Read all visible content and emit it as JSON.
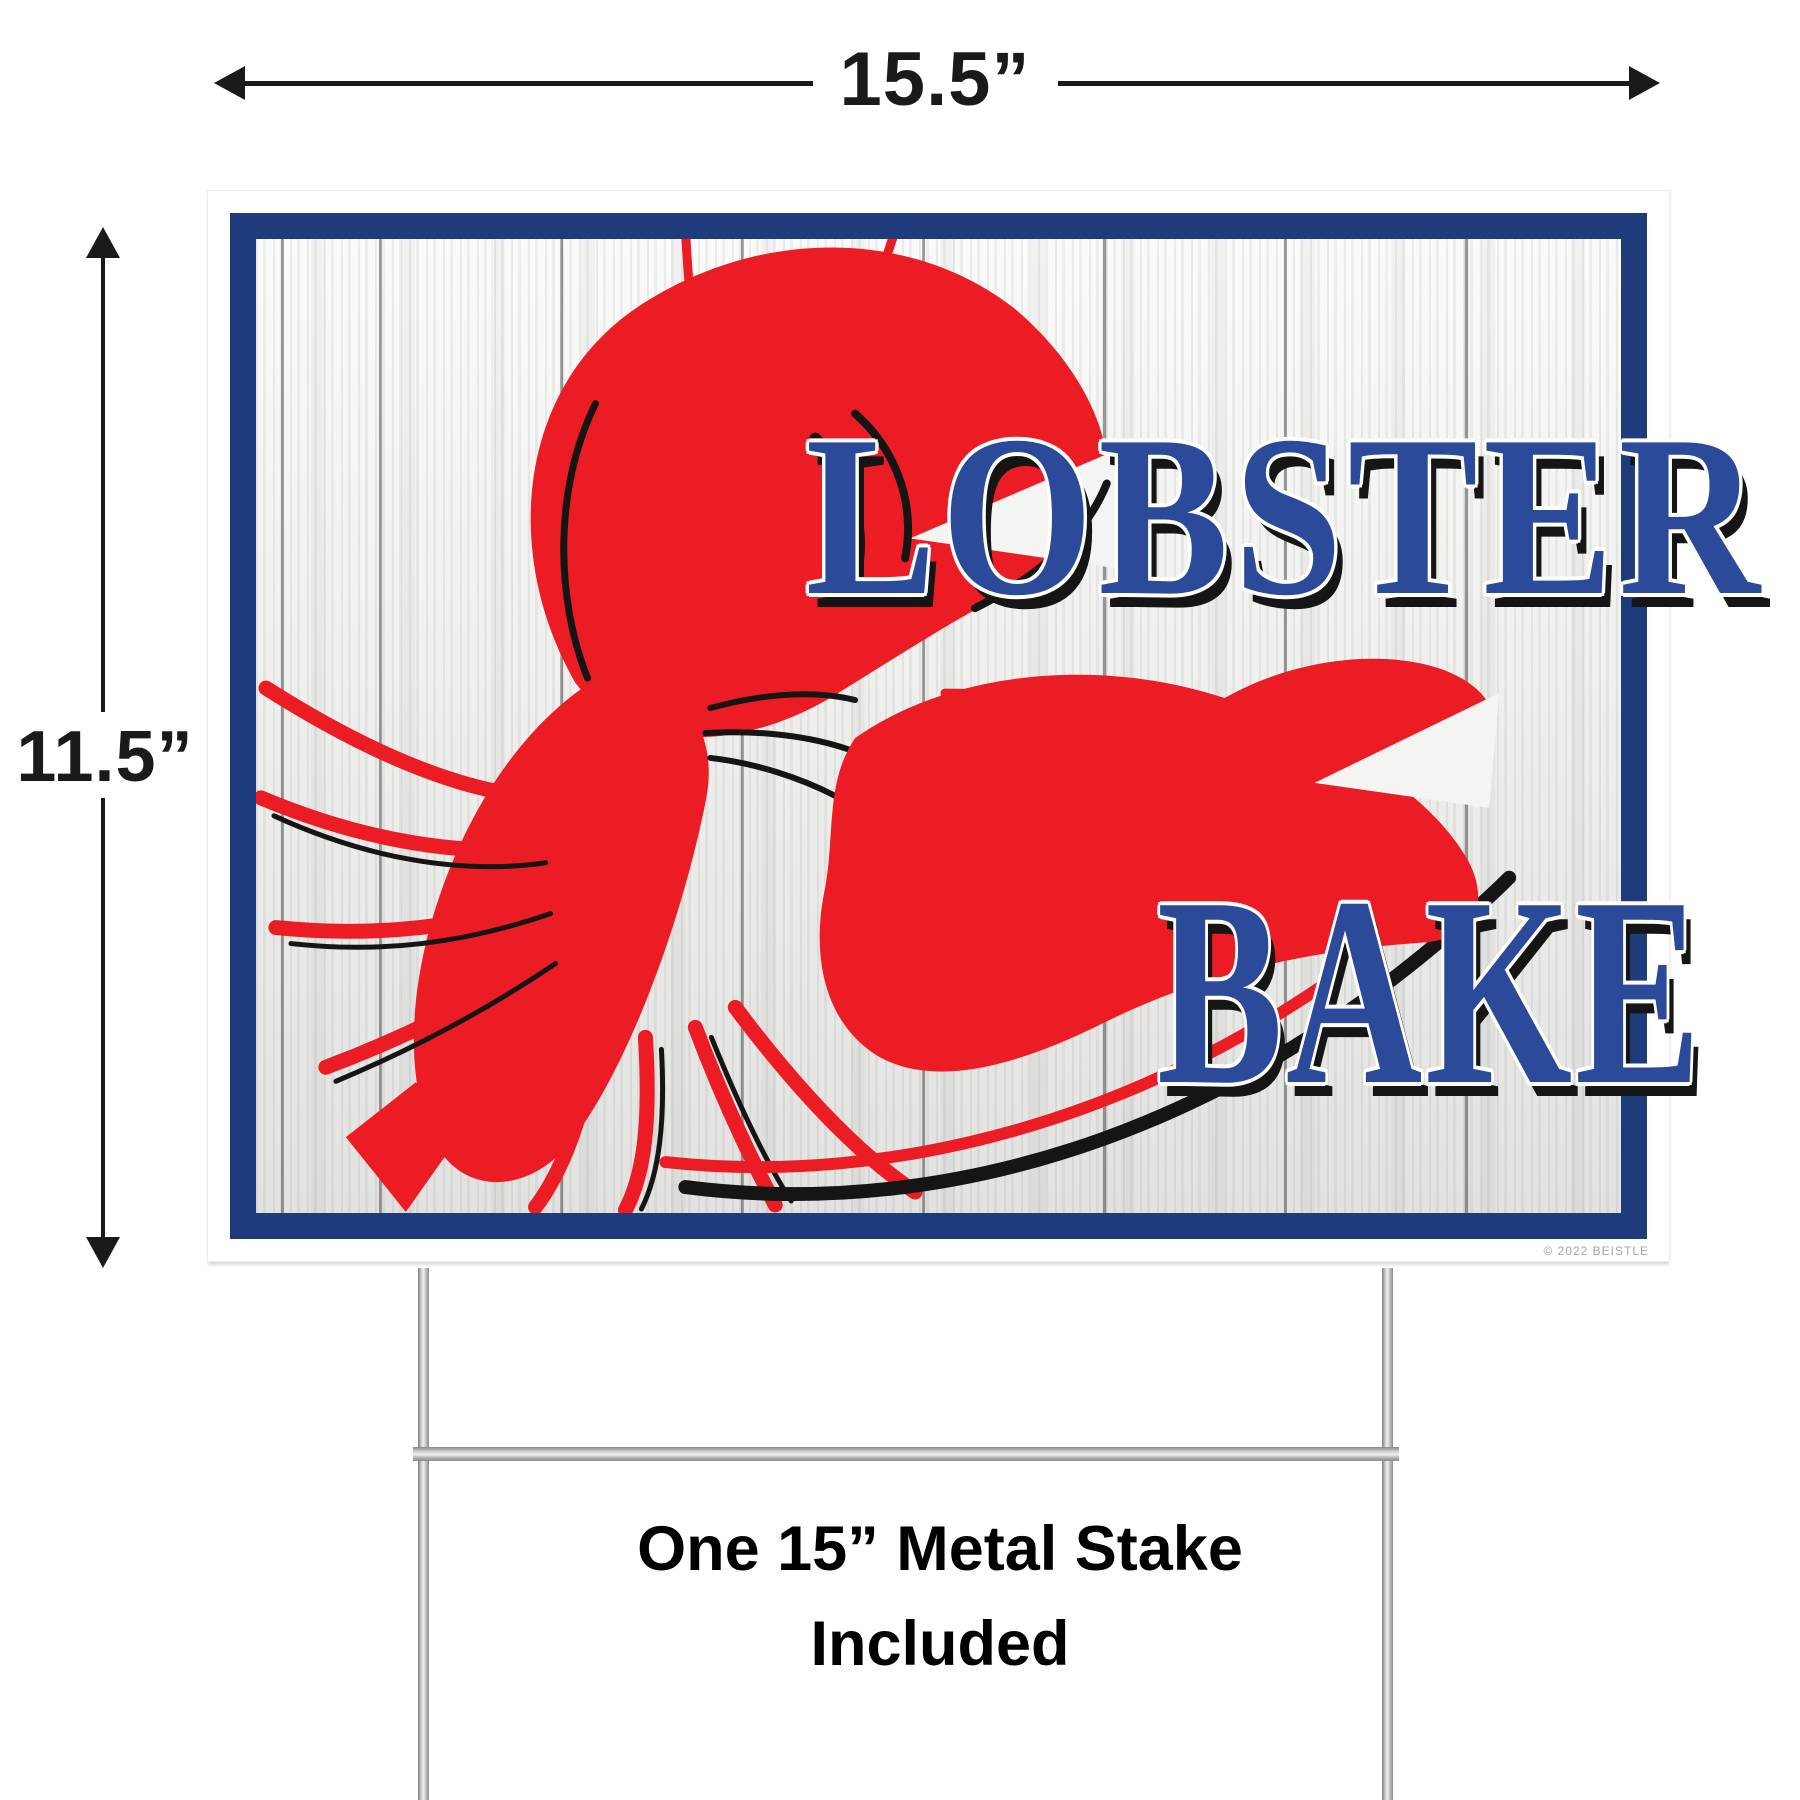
{
  "dimensions": {
    "width_label": "15.5”",
    "height_label": "11.5”"
  },
  "sign": {
    "title_line1": "LOBSTER",
    "title_line2": "BAKE",
    "copyright": "© 2022 BEISTLE"
  },
  "stake": {
    "caption_line1": "One 15” Metal Stake",
    "caption_line2": "Included"
  },
  "icons": {
    "width_arrows": "double-headed-horizontal-arrow",
    "height_arrows": "double-headed-vertical-arrow",
    "artwork": "red-lobster-silhouette"
  },
  "colors": {
    "border_navy": "#1e3c7c",
    "letter_blue": "#2b4a99",
    "lobster_red": "#ec1c24",
    "accent_black": "#151515",
    "wood_base": "#f4f4f2",
    "stake_light": "#efefef",
    "stake_dark": "#8b8b8b",
    "dimension_ink": "#1a1a1a",
    "copyright_gray": "#a5a5a5"
  }
}
